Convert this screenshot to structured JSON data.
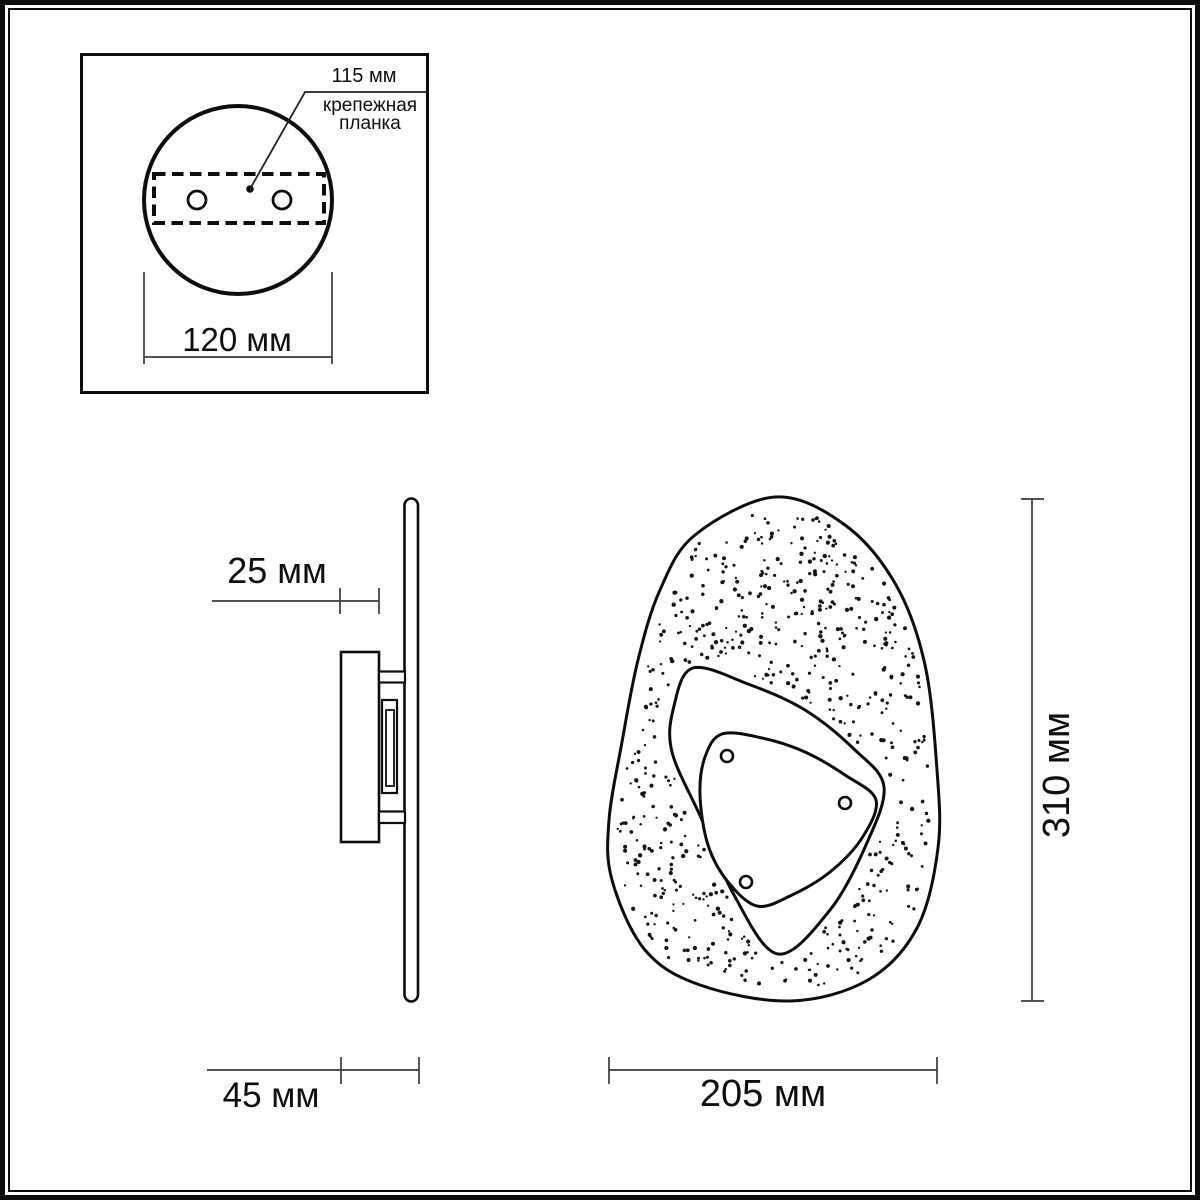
{
  "drawing": {
    "background": "#ffffff",
    "line_color": "#111111",
    "dim_color": "#3a3a3a",
    "views": {
      "mounting_plate": {
        "hole_spacing_label": "115 мм",
        "part_label_line1": "крепежная",
        "part_label_line2": "планка",
        "plate_width_label": "120 мм"
      },
      "side": {
        "base_depth_label": "25 мм",
        "total_depth_label": "45 мм"
      },
      "front": {
        "width_label": "205 мм",
        "height_label": "310 мм"
      }
    }
  }
}
